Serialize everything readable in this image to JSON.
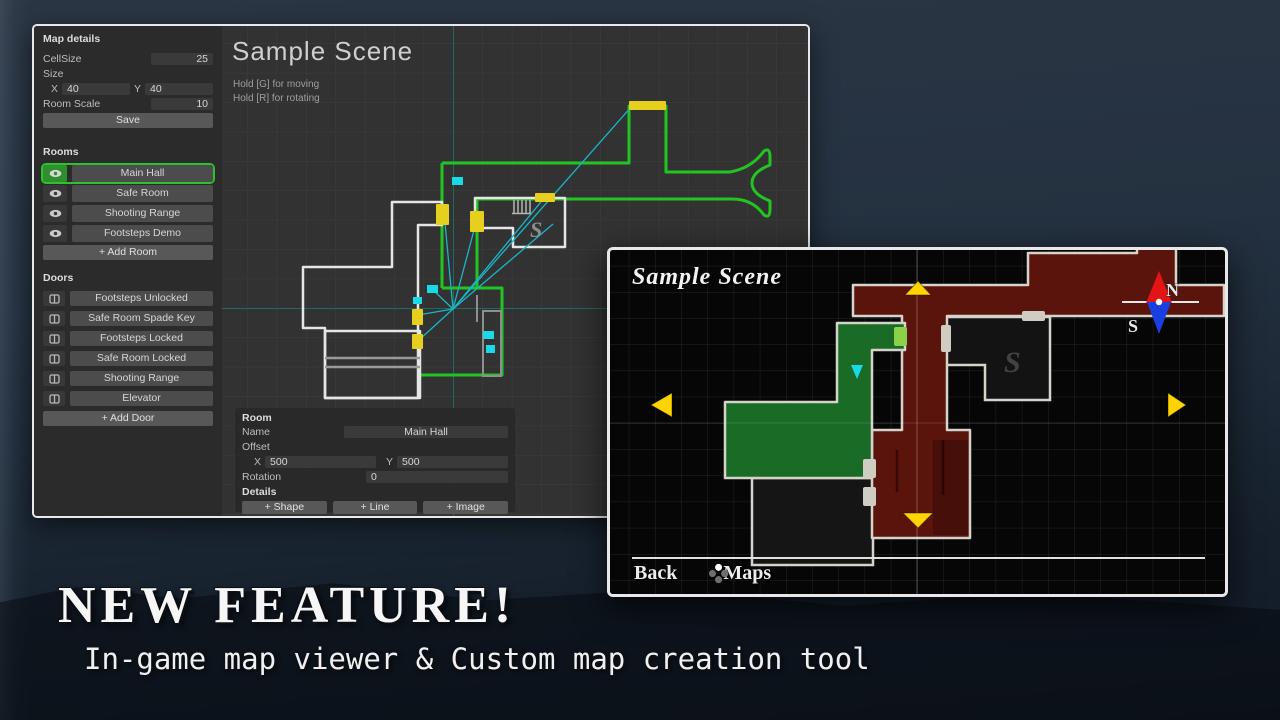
{
  "editor": {
    "map_details": {
      "title": "Map details",
      "cellsize_label": "CellSize",
      "cellsize_value": "25",
      "size_label": "Size",
      "x_label": "X",
      "x_value": "40",
      "y_label": "Y",
      "y_value": "40",
      "room_scale_label": "Room Scale",
      "room_scale_value": "10",
      "save_label": "Save"
    },
    "rooms": {
      "title": "Rooms",
      "items": [
        "Main Hall",
        "Safe Room",
        "Shooting Range",
        "Footsteps Demo"
      ],
      "add_label": "+ Add Room"
    },
    "doors": {
      "title": "Doors",
      "items": [
        "Footsteps Unlocked",
        "Safe Room Spade Key",
        "Footsteps Locked",
        "Safe Room Locked",
        "Shooting Range",
        "Elevator"
      ],
      "add_label": "+ Add Door"
    },
    "canvas": {
      "title": "Sample Scene",
      "hint_move": "Hold [G] for moving",
      "hint_rotate": "Hold [R] for rotating",
      "stairs_label": "S"
    },
    "room_panel": {
      "title": "Room",
      "name_label": "Name",
      "name_value": "Main Hall",
      "offset_label": "Offset",
      "x_label": "X",
      "x_value": "500",
      "y_label": "Y",
      "y_value": "500",
      "rotation_label": "Rotation",
      "rotation_value": "0",
      "details_label": "Details",
      "add_shape_label": "+ Shape",
      "add_line_label": "+ Line",
      "add_image_label": "+ Image"
    }
  },
  "viewer": {
    "title": "Sample Scene",
    "compass_north": "N",
    "compass_south": "S",
    "stairs_label": "S",
    "back_label": "Back",
    "maps_label": "Maps"
  },
  "banner": {
    "headline": "NEW FEATURE!",
    "subtitle": "In-game map viewer & Custom map creation tool"
  },
  "colors": {
    "selection_green": "#2ec22e",
    "door_yellow": "#e6cf1d",
    "marker_cyan": "#19dbe8",
    "room_green_fill": "#1a6b25",
    "room_red_fill": "#5a140c",
    "arrow_yellow": "#ffd400",
    "compass_north_red": "#e31414",
    "compass_south_blue": "#1a3fe0"
  }
}
